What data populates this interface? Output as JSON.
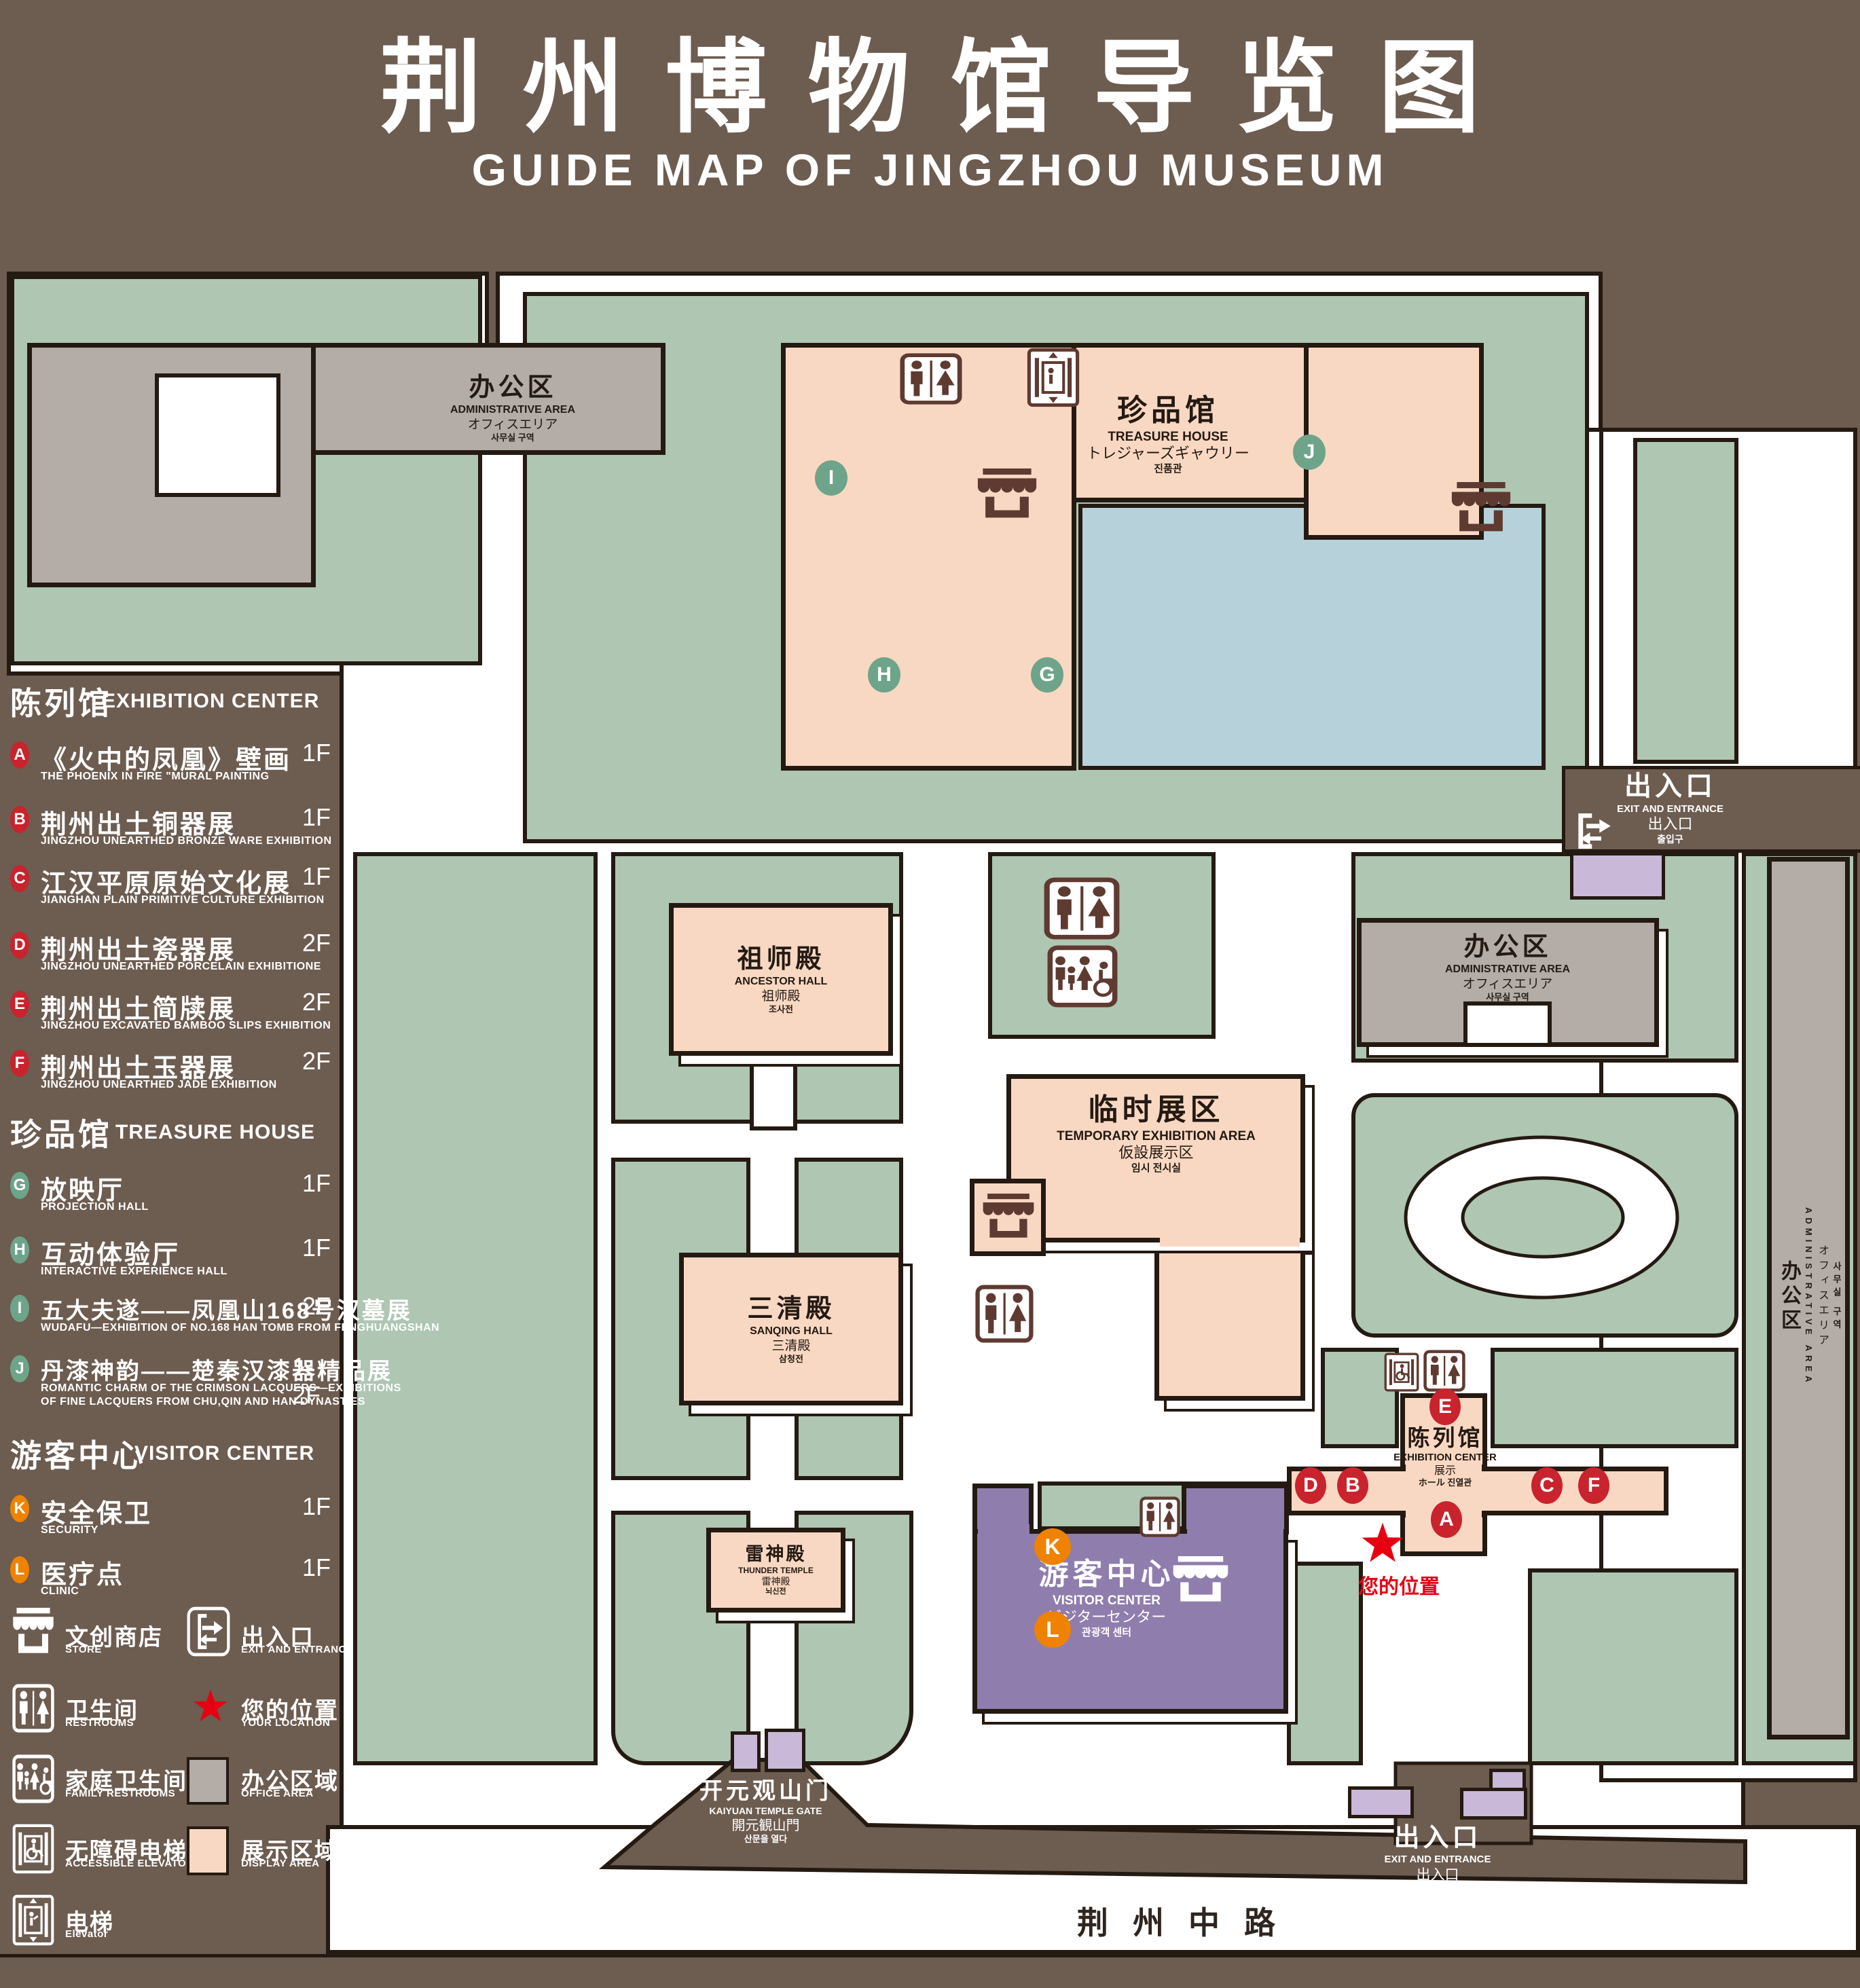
{
  "title": {
    "cn": "荆州博物馆导览图",
    "en": "GUIDE MAP OF JINGZHOU MUSEUM"
  },
  "colors": {
    "background": "#6d5c50",
    "green_area": "#aec6b2",
    "display_area": "#f9d8c3",
    "office_area": "#b3aca7",
    "visitor_center": "#8f7dad",
    "entrance_building": "#c9b8d8",
    "water": "#b7d1da",
    "outline": "#241a12",
    "badge_red": "#c9232e",
    "badge_green": "#6ea489",
    "badge_orange": "#ef8200",
    "star_red": "#e60012",
    "icon_brown": "#5f3a31"
  },
  "legend": {
    "sections": [
      {
        "cn": "陈列馆",
        "en": "EXHIBITION CENTER",
        "items": [
          {
            "letter": "A",
            "cn": "《火中的凤凰》壁画",
            "en": "THE PHOENIX IN FIRE \"MURAL PAINTING",
            "floor": "1F"
          },
          {
            "letter": "B",
            "cn": "荆州出土铜器展",
            "en": "JINGZHOU UNEARTHED BRONZE WARE EXHIBITION",
            "floor": "1F"
          },
          {
            "letter": "C",
            "cn": "江汉平原原始文化展",
            "en": "JIANGHAN PLAIN PRIMITIVE CULTURE EXHIBITION",
            "floor": "1F"
          },
          {
            "letter": "D",
            "cn": "荆州出土瓷器展",
            "en": "JINGZHOU UNEARTHED PORCELAIN EXHIBITIONE",
            "floor": "2F"
          },
          {
            "letter": "E",
            "cn": "荆州出土简牍展",
            "en": "JINGZHOU EXCAVATED BAMBOO SLIPS EXHIBITION",
            "floor": "2F"
          },
          {
            "letter": "F",
            "cn": "荆州出土玉器展",
            "en": "JINGZHOU UNEARTHED JADE EXHIBITION",
            "floor": "2F"
          }
        ]
      },
      {
        "cn": "珍品馆",
        "en": "TREASURE HOUSE",
        "items": [
          {
            "letter": "G",
            "cn": "放映厅",
            "en": "PROJECTION HALL",
            "floor": "1F"
          },
          {
            "letter": "H",
            "cn": "互动体验厅",
            "en": "INTERACTIVE EXPERIENCE HALL",
            "floor": "1F"
          },
          {
            "letter": "I",
            "cn": "五大夫遂——凤凰山168号汉墓展",
            "en": "WUDAFU—EXHIBITION OF NO.168 HAN TOMB FROM FENGHUANGSHAN",
            "floor": "2F"
          },
          {
            "letter": "J",
            "cn": "丹漆神韵——楚秦汉漆器精品展",
            "en": "ROMANTIC CHARM OF THE CRIMSON LACQUERS—EXHIBITIONS",
            "en2": "OF FINE LACQUERS FROM CHU,QIN AND HAN DYNASTIES",
            "floor": "1-2F"
          }
        ]
      },
      {
        "cn": "游客中心",
        "en": "VISITOR CENTER",
        "items": [
          {
            "letter": "K",
            "cn": "安全保卫",
            "en": "SECURITY",
            "floor": "1F"
          },
          {
            "letter": "L",
            "cn": "医疗点",
            "en": "CLINIC",
            "floor": "1F"
          }
        ]
      }
    ],
    "symbols": [
      {
        "cn": "文创商店",
        "en": "STORE"
      },
      {
        "cn": "出入口",
        "en": "EXIT AND ENTRANCE"
      },
      {
        "cn": "卫生间",
        "en": "RESTROOMS"
      },
      {
        "cn": "您的位置",
        "en": "YOUR LOCATION"
      },
      {
        "cn": "家庭卫生间",
        "en": "FAMILY RESTROOMS"
      },
      {
        "cn": "办公区域",
        "en": "OFFICE AREA"
      },
      {
        "cn": "无障碍电梯",
        "en": "ACCESSIBLE ELEVATOR"
      },
      {
        "cn": "展示区域",
        "en": "DISPLAY AREA"
      },
      {
        "cn": "电梯",
        "en": "Elevator"
      }
    ]
  },
  "map": {
    "badge_letters": {
      "A": "A",
      "B": "B",
      "C": "C",
      "D": "D",
      "E": "E",
      "F": "F",
      "G": "G",
      "H": "H",
      "I": "I",
      "J": "J",
      "K": "K",
      "L": "L"
    },
    "admin_area": {
      "cn": "办公区",
      "en": "ADMINISTRATIVE AREA",
      "jp": "オフィスエリア",
      "kr": "사무실 구역"
    },
    "treasure_house": {
      "cn": "珍品馆",
      "en": "TREASURE HOUSE",
      "jp": "トレジャーズギャウリー",
      "kr": "진품관"
    },
    "ancestor_hall": {
      "cn": "祖师殿",
      "en": "ANCESTOR HALL",
      "jp": "祖师殿",
      "kr": "조사전"
    },
    "temporary_area": {
      "cn": "临时展区",
      "en": "TEMPORARY EXHIBITION AREA",
      "jp": "仮設展示区",
      "kr": "임시 전시실"
    },
    "sanqing_hall": {
      "cn": "三清殿",
      "en": "SANQING HALL",
      "jp": "三清殿",
      "kr": "삼청전"
    },
    "thunder_temple": {
      "cn": "雷神殿",
      "en": "THUNDER TEMPLE",
      "jp": "雷神殿",
      "kr": "뇌신전"
    },
    "visitor_center": {
      "cn": "游客中心",
      "en": "VISITOR CENTER",
      "jp": "ビジターセンター",
      "kr": "관광객 센터"
    },
    "exhibition_center": {
      "cn": "陈列馆",
      "en": "EXHIBITION CENTER",
      "jp": "展示",
      "kr": "ホール 진열관"
    },
    "gate": {
      "cn": "开元观山门",
      "en": "KAIYUAN TEMPLE GATE",
      "jp": "開元観山門",
      "kr": "산문을 열다"
    },
    "exit": {
      "cn": "出入口",
      "en": "EXIT AND ENTRANCE",
      "jp": "出入口",
      "kr": "출입구"
    },
    "your_location": "您的位置",
    "road": "荆州中路"
  }
}
